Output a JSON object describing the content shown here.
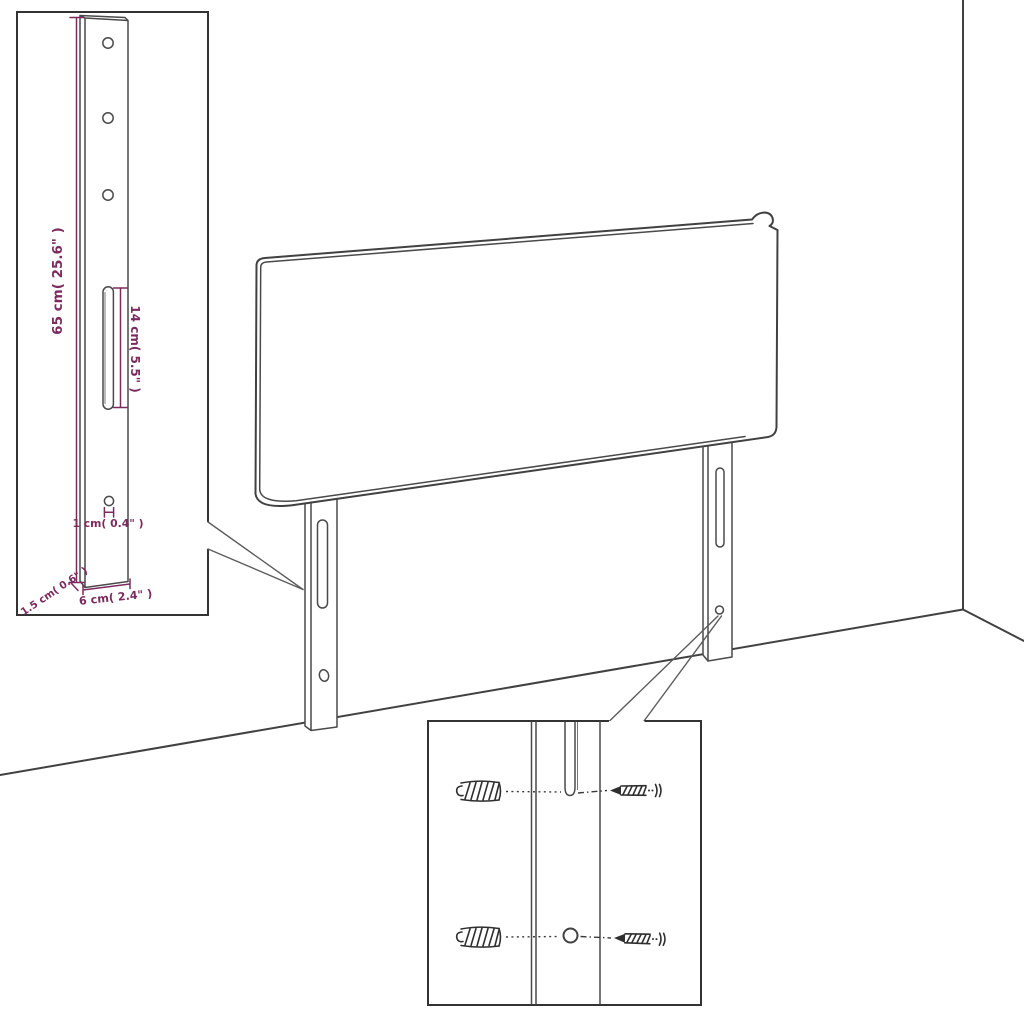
{
  "diagram": {
    "subject": "headboard-assembly-dimension-diagram",
    "dimensions": {
      "height_label": "65 cm( 25.6\" )",
      "slot_label": "14 cm( 5.5\" )",
      "hole_label": "1 cm( 0.4\" )",
      "thickness_label": "1.5 cm( 0.6\" )",
      "width_label": "6 cm( 2.4\" )"
    },
    "colors": {
      "dimension_accent": "#7b2b5e",
      "drawing_line": "#414141",
      "background": "#ffffff"
    }
  }
}
